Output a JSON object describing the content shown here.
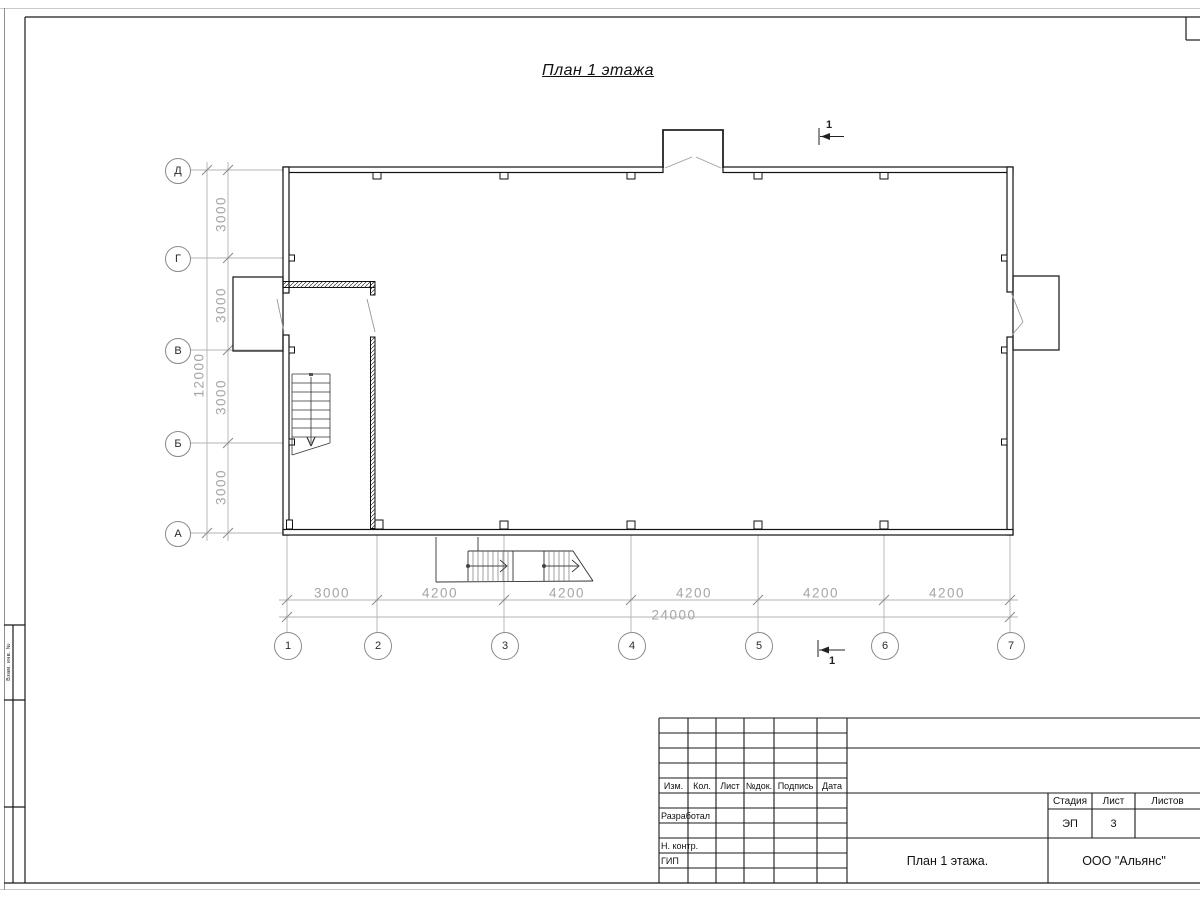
{
  "title": "План 1 этажа",
  "colors": {
    "ink": "#1a1a1a",
    "dim_gray": "#a5a5a5",
    "axis_gray": "#b0b0b0"
  },
  "axes": {
    "rows": [
      "Д",
      "Г",
      "В",
      "Б",
      "А"
    ],
    "cols": [
      "1",
      "2",
      "3",
      "4",
      "5",
      "6",
      "7"
    ]
  },
  "dims": {
    "left_segments": [
      "3000",
      "3000",
      "3000",
      "3000"
    ],
    "left_total": "12000",
    "bottom_segments": [
      "3000",
      "4200",
      "4200",
      "4200",
      "4200",
      "4200"
    ],
    "bottom_total": "24000"
  },
  "sections": {
    "top": "1",
    "bottom": "1"
  },
  "side_stamp": {
    "row1": "Взам. инв. №"
  },
  "title_block": {
    "cols": [
      "Изм.",
      "Кол.",
      "Лист",
      "№док.",
      "Подпись",
      "Дата"
    ],
    "roles": [
      "Разработал",
      "Н. контр.",
      "ГИП"
    ],
    "stage_label": "Стадия",
    "sheet_label": "Лист",
    "sheets_label": "Листов",
    "stage_value": "ЭП",
    "sheet_value": "3",
    "doc_title": "План 1 этажа.",
    "company": "ООО \"Альянс\""
  }
}
